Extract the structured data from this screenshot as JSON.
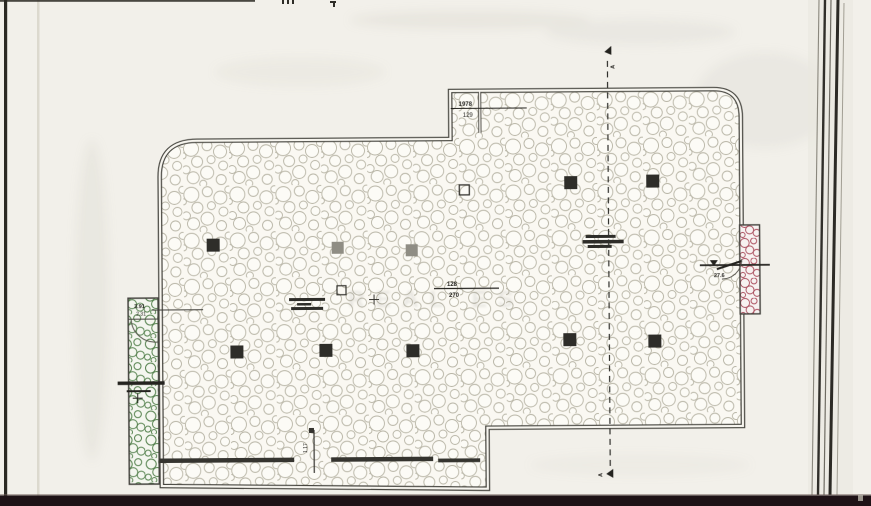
{
  "page": {
    "title": "Potkrovlje:",
    "watermark_text": "REAL ES"
  },
  "plan": {
    "section_marker_top": "A",
    "section_marker_bottom": "A",
    "dim_notch_upper": "1978",
    "dim_notch_lower": "129",
    "dim_center_upper": "128",
    "dim_center_lower": "270",
    "dim_left_upper": "3.91",
    "dim_left_lower": "2.31",
    "dim_right": "27.6",
    "dim_bottom": "1.17"
  },
  "colors": {
    "paper": "#f2f0ea",
    "plan_fill": "#faf8f2",
    "ink": "#3b3a35",
    "cobble_stroke": "#b8b5a6",
    "terrace_green": "#55824e",
    "balcony_red": "#aa4c5c",
    "bottom_bar": "#1e1216"
  }
}
